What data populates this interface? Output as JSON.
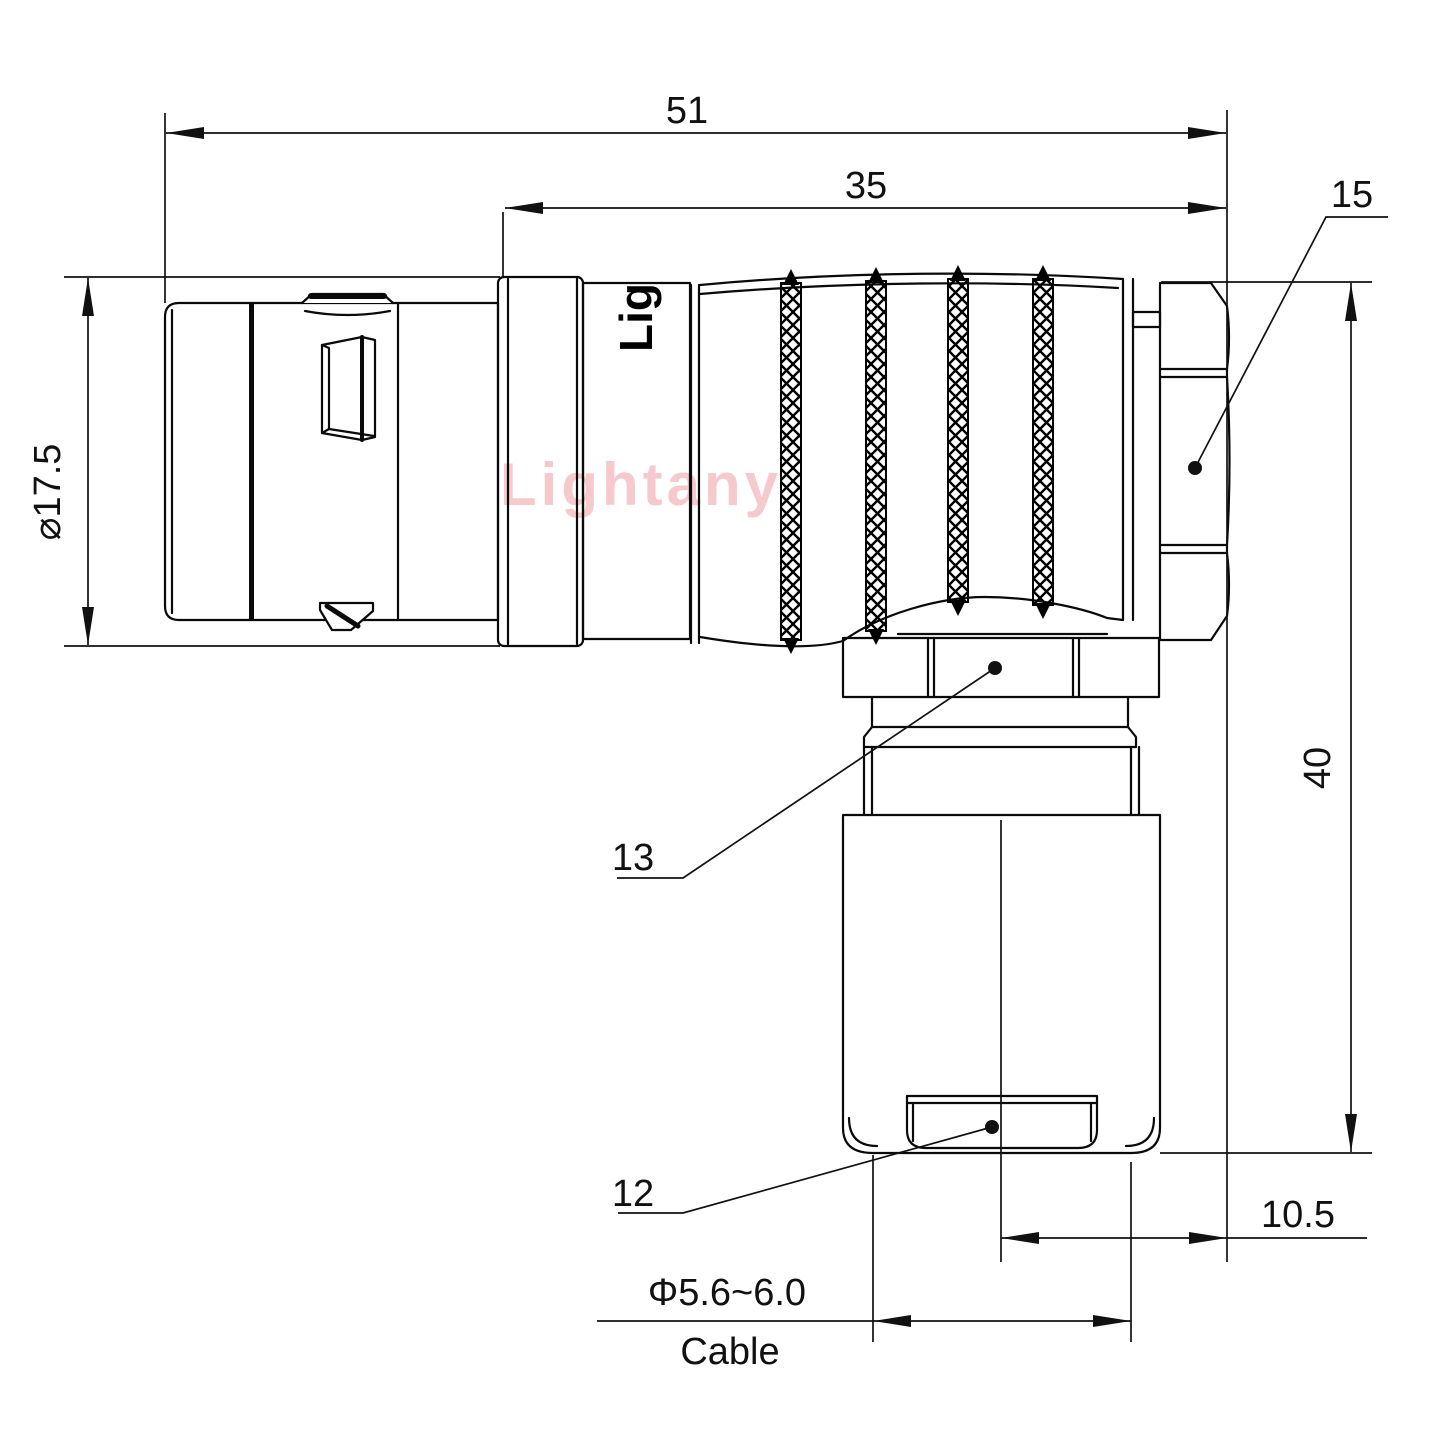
{
  "watermark": {
    "text": "Lightany",
    "color": "#f6c9cd"
  },
  "body_marking": {
    "text": "Lig"
  },
  "dimensions": {
    "overall_length": "51",
    "rear_length": "35",
    "coupling_nut_ref": "15",
    "front_diameter": "⌀17.5",
    "height": "40",
    "elbow_nut_ref": "13",
    "cable_clamp_ref": "12",
    "axis_offset": "10.5",
    "cable_diameter_range": "Φ5.6~6.0",
    "cable_caption": "Cable"
  },
  "colors": {
    "line": "#0a0a0a",
    "background": "#ffffff"
  }
}
